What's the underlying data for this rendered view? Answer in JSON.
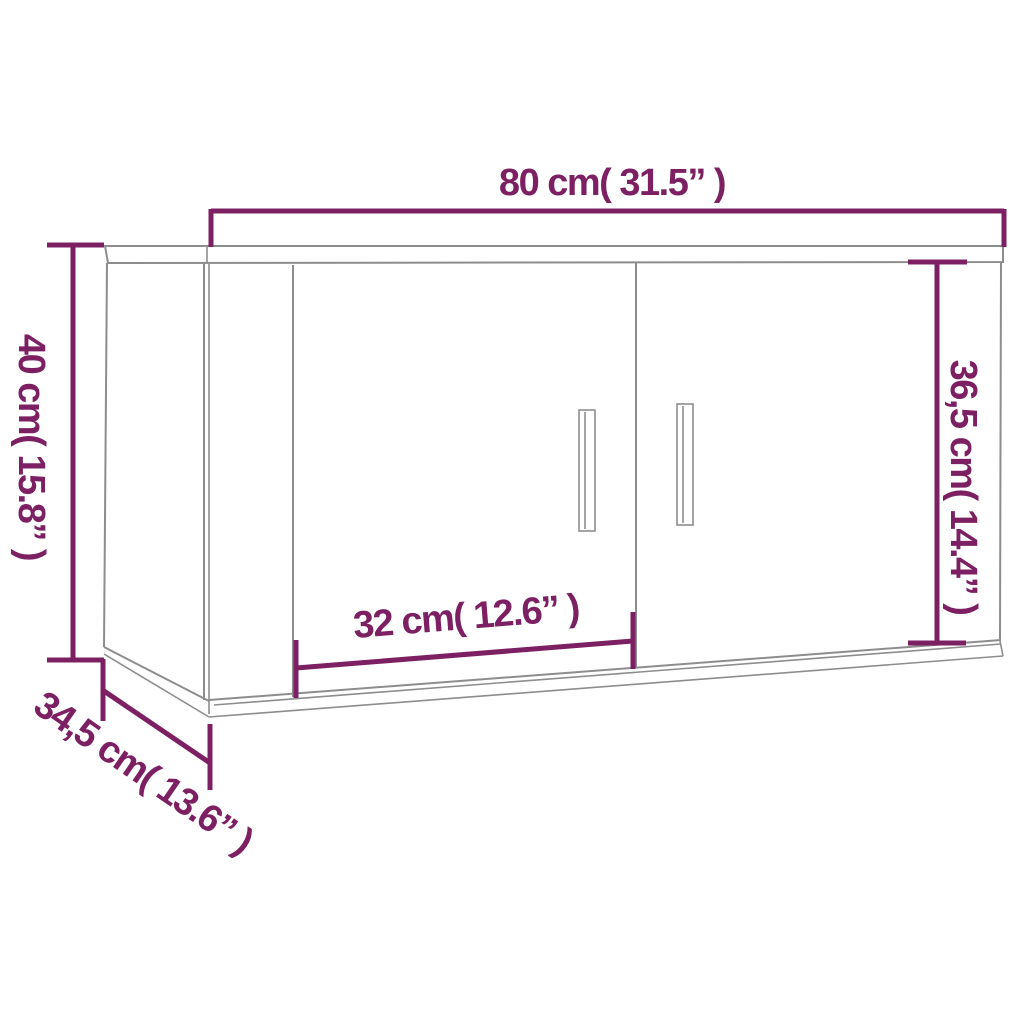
{
  "diagram": {
    "kind": "furniture-dimension-diagram",
    "object": "wall-cabinet-two-doors",
    "dimensions": {
      "width_label": "80 cm( 31.5” )",
      "height_label": "40 cm( 15.8” )",
      "front_height_label": "36,5 cm( 14.4” )",
      "door_width_label": "32 cm( 12.6” )",
      "depth_label": "34,5 cm( 13.6” )"
    },
    "colors": {
      "accent": "#7D2063",
      "line": "#8D8D8D",
      "background": "#FFFFFF"
    }
  }
}
